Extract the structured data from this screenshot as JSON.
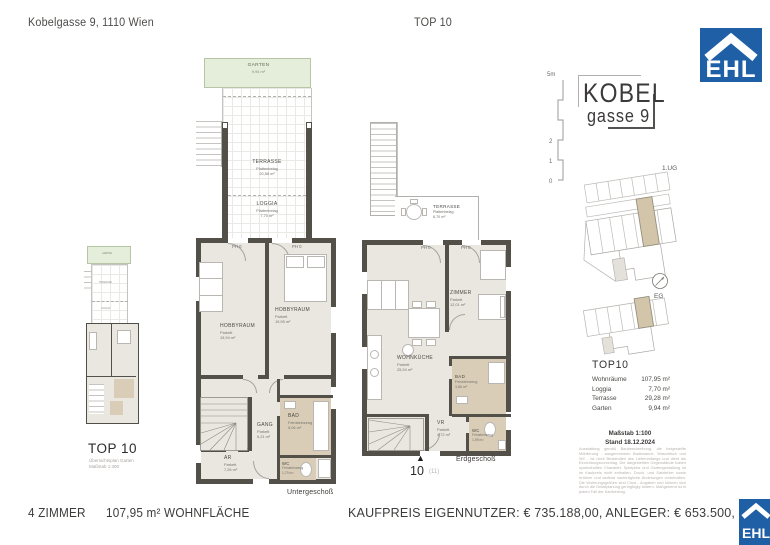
{
  "header": {
    "address": "Kobelgasse 9, 1110 Wien",
    "unit": "TOP 10"
  },
  "logo": {
    "text": "EHL"
  },
  "brand": {
    "line1": "KOBEL",
    "line2": "gasse 9"
  },
  "scale_bar": {
    "top_label": "5m",
    "marks": [
      "2",
      "1",
      "0"
    ]
  },
  "site_plans": {
    "ug_label": "1.UG",
    "eg_label": "EG"
  },
  "overview": {
    "title": "TOP 10",
    "subtitle": "Übersichtsplan Garten",
    "scale": "Maßstab 1:300",
    "labels": {
      "garten": "GARTEN",
      "terrasse": "TERRASSE",
      "loggia": "LOGGIA"
    }
  },
  "ug_plan": {
    "caption": "Untergeschoß",
    "garten": {
      "name": "GARTEN",
      "area": "9,94 m²"
    },
    "terrasse": {
      "name": "TERRASSE",
      "floor": "Plattenbelag",
      "area": "20,58 m²"
    },
    "loggia": {
      "name": "LOGGIA",
      "floor": "Plattenbelag",
      "area": "7,70 m²"
    },
    "ph_left": "PH 0",
    "ph_right": "PH 0",
    "hobbyraum_left": {
      "name": "HOBBYRAUM",
      "floor": "Parkett",
      "area": "19,94 m²"
    },
    "hobbyraum_right": {
      "name": "HOBBYRAUM",
      "floor": "Parkett",
      "area": "19,95 m²"
    },
    "gang": {
      "name": "GANG",
      "floor": "Parkett",
      "area": "6,21 m²"
    },
    "bad": {
      "name": "BAD",
      "floor": "Feinsteinzeug",
      "area": "5,06 m²"
    },
    "ar": {
      "name": "AR",
      "floor": "Parkett",
      "area": "7,26 m²"
    },
    "wc": {
      "name": "WC",
      "floor": "Feinsteinzeug",
      "area": "1,70 m²"
    }
  },
  "eg_plan": {
    "caption": "Erdgeschoß",
    "terrasse": {
      "name": "TERRASSE",
      "floor": "Plattenbelag",
      "area": "8,70 m²"
    },
    "ph_left": "PH 0",
    "ph_right": "PH 0",
    "zimmer": {
      "name": "ZIMMER",
      "floor": "Parkett",
      "area": "12,01 m²"
    },
    "wohnkueche": {
      "name": "WOHNKÜCHE",
      "floor": "Parkett",
      "area": "25,94 m²"
    },
    "bad": {
      "name": "BAD",
      "floor": "Feinsteinzeug",
      "area": "3,86 m²"
    },
    "vr": {
      "name": "VR",
      "floor": "Parkett",
      "area": "4,72 m²"
    },
    "wc": {
      "name": "WC",
      "floor": "Feinsteinzeug",
      "area": "1,59 m²"
    },
    "entrance_number": "10",
    "entrance_note": "(11)"
  },
  "summary": {
    "title": "TOP10",
    "rows": [
      {
        "label": "Wohnräume",
        "value": "107,95 m²"
      },
      {
        "label": "Loggia",
        "value": "7,70 m²"
      },
      {
        "label": "Terrasse",
        "value": "29,28 m²"
      },
      {
        "label": "Garten",
        "value": "9,94 m²"
      }
    ],
    "scale": "Maßstab 1:100",
    "date": "Stand 18.12.2024",
    "disclaimer": "Ausstattung gemäß Baubeschreibung, die beigestellte Möblierung - ausgenommen Badewanne, Waschtisch und WC - ist nicht Bestandteil des Lieferumfangs und dient als Einrichtungsvorschlag. Die dargestellten Gegenstände haben symbolhaften Charakter. Spielplatz und Gartengestaltung ist im Kaufpreis nicht enthalten. Druck- und Satzfehler sowie Irrtümer und laufend nachträgliche Änderungen vorbehalten. Die Wohnungsgrößen sind Circa - Angaben und können sich durch die Detailplanung geringfügig ändern. Maßgebend ist in jedem Fall der Kaufvertrag."
  },
  "footer": {
    "rooms": "4 ZIMMER",
    "area": "107,95 m² WOHNFLÄCHE",
    "price": "KAUFPREIS EIGENNUTZER: € 735.188,00, ANLEGER: € 653.500,"
  },
  "colors": {
    "brand_blue": "#1e5fa6",
    "garden_green": "#e5eeda",
    "room_beige": "#eae7e1",
    "wet_tan": "#d9cdb7",
    "wall_dark": "#53504a",
    "highlight_tan": "#d2c5a9"
  }
}
